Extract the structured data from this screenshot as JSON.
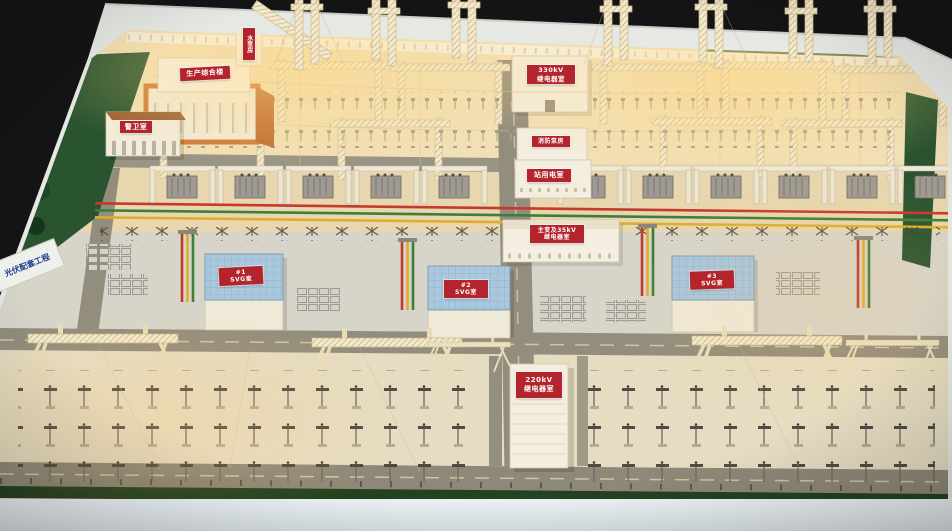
{
  "signs": {
    "pv_banner": "光伏配套工程",
    "admin_building": "生产综合楼",
    "pump_tower": "水泵房",
    "guard_room": "警卫室",
    "relay_330": {
      "line1": "330kV",
      "line2": "继电器室"
    },
    "fire_pump": "消防泵房",
    "station_power": "站用电室",
    "main_transformer_relay": {
      "line1": "主变及35kV",
      "line2": "继电器室"
    },
    "svg_rooms": [
      {
        "line1": "#1",
        "line2": "SVG室"
      },
      {
        "line1": "#2",
        "line2": "SVG室"
      },
      {
        "line1": "#3",
        "line2": "SVG室"
      }
    ],
    "relay_220": {
      "line1": "220kV",
      "line2": "继电器室"
    }
  },
  "colors": {
    "sign_red": "#b3242c",
    "busbar_red": "#c43a2c",
    "busbar_green": "#3f7d3a",
    "busbar_yellow": "#ddae2e",
    "svg_roof_blue": "#a9c7dd",
    "grass_green": "#2a5430",
    "warm_ground": "#f1dfb6",
    "truss_cream": "#f2e9cf",
    "table_frame": "#e6e8e4",
    "road_gray": "#938d7d"
  }
}
